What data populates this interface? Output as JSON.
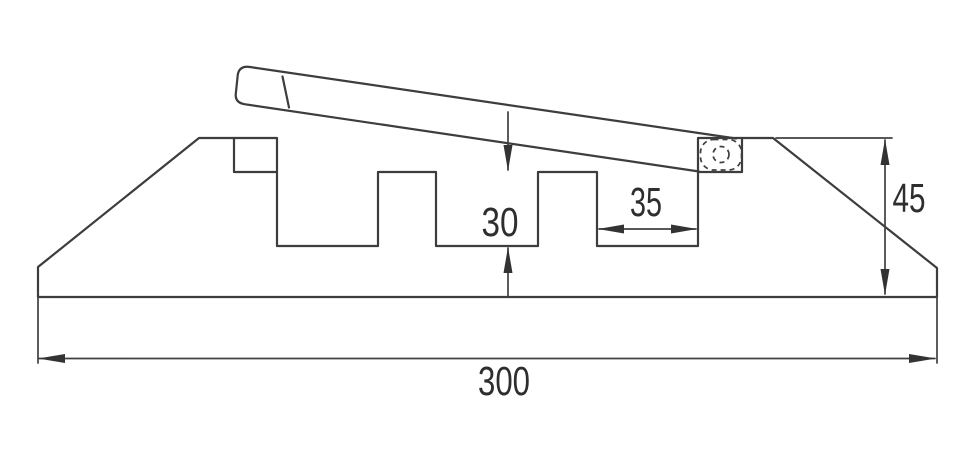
{
  "drawing": {
    "type": "technical-cross-section",
    "subject": "cable-protector-ramp-profile-with-open-hinged-lid",
    "colors": {
      "background": "#ffffff",
      "line": "#3d3d3d",
      "dimension_line": "#404040",
      "text": "#2e2e2e"
    },
    "dimensions": {
      "channel_depth": {
        "value": "30",
        "orientation": "vertical"
      },
      "channel_width": {
        "value": "35",
        "orientation": "horizontal"
      },
      "end_height": {
        "value": "45",
        "orientation": "vertical"
      },
      "overall_width": {
        "value": "300",
        "orientation": "horizontal"
      }
    }
  }
}
